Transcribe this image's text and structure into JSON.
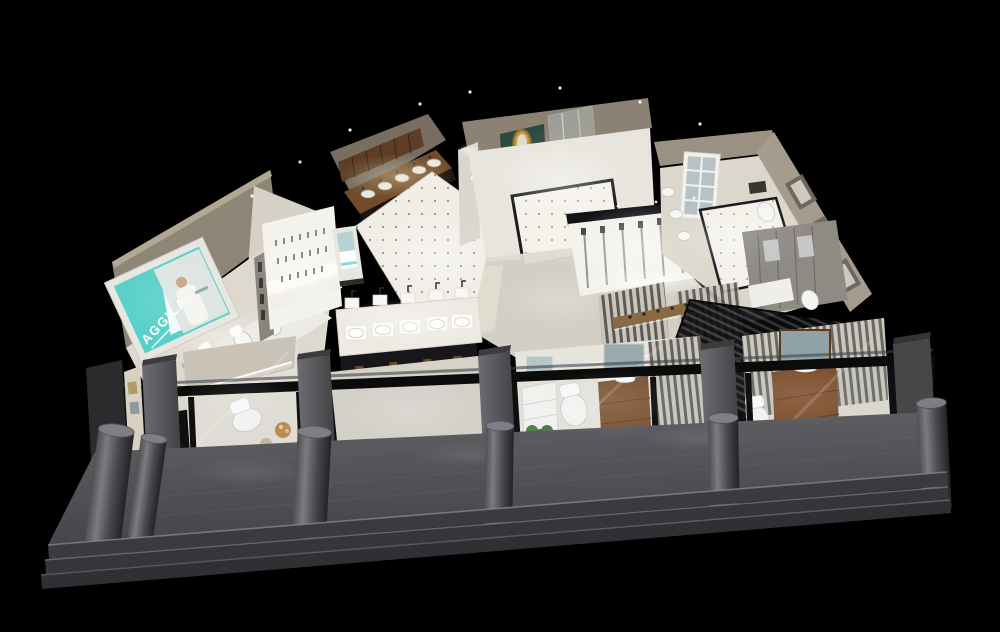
{
  "meta": {
    "width": 1000,
    "height": 632,
    "kind": "aerial 3D cutaway render of a bathroom fixtures showroom at night"
  },
  "scene": {
    "background": "#000000",
    "brand_sign": {
      "text": "AGGILA",
      "panel_color": "#55cfc7",
      "text_color": "#ffffff"
    },
    "colors": {
      "floor_light": "#ece9e2",
      "wall_beige": "#948a7b",
      "wood_cabinet": "#5d3d24",
      "wood_vanity": "#7a4e2b",
      "walkway_gray": "#55555a",
      "step_gray": "#36363a",
      "glass_tint": "#b8c6cc",
      "pillar_gray": "#58585c",
      "pergola_dark": "#0c0c0c"
    },
    "areas": [
      {
        "name": "brand-sign-wall",
        "label": "Teal AGGILA lightbox sign with model photo"
      },
      {
        "name": "toilet-display-platform",
        "label": "Row of toilets on display platform"
      },
      {
        "name": "wooden-sink-cabinets",
        "label": "Wooden cabinet run with inset sinks"
      },
      {
        "name": "tiled-aisle",
        "label": "White tiled aisle with dark dot inlays"
      },
      {
        "name": "faucet-display-wall",
        "label": "Back-lit stepped faucet display"
      },
      {
        "name": "basin-display-tables",
        "label": "Tables with countertop basins and faucets"
      },
      {
        "name": "luxury-vignette",
        "label": "Classic vanity, ornate gold mirror and glass shower"
      },
      {
        "name": "shower-column-wall",
        "label": "Back-lit shower column display wall"
      },
      {
        "name": "french-window-room",
        "label": "Room with white french window"
      },
      {
        "name": "right-display-wall",
        "label": "Angled outer wall with recessed displays and toilets"
      },
      {
        "name": "slat-partition-vignettes",
        "label": "Bathroom vignettes behind wood slat partitions"
      },
      {
        "name": "pergola-roof",
        "label": "Dark louvered pergola roof"
      },
      {
        "name": "storefront",
        "label": "Black framed glass storefront with gray pillars"
      },
      {
        "name": "entrance",
        "label": "Open entrance bay between pillars"
      },
      {
        "name": "bollards",
        "label": "Round concrete bollards on walkway"
      },
      {
        "name": "walkway",
        "label": "Gray stone apron walkway"
      },
      {
        "name": "entry-steps",
        "label": "Three shallow entry steps"
      }
    ]
  }
}
